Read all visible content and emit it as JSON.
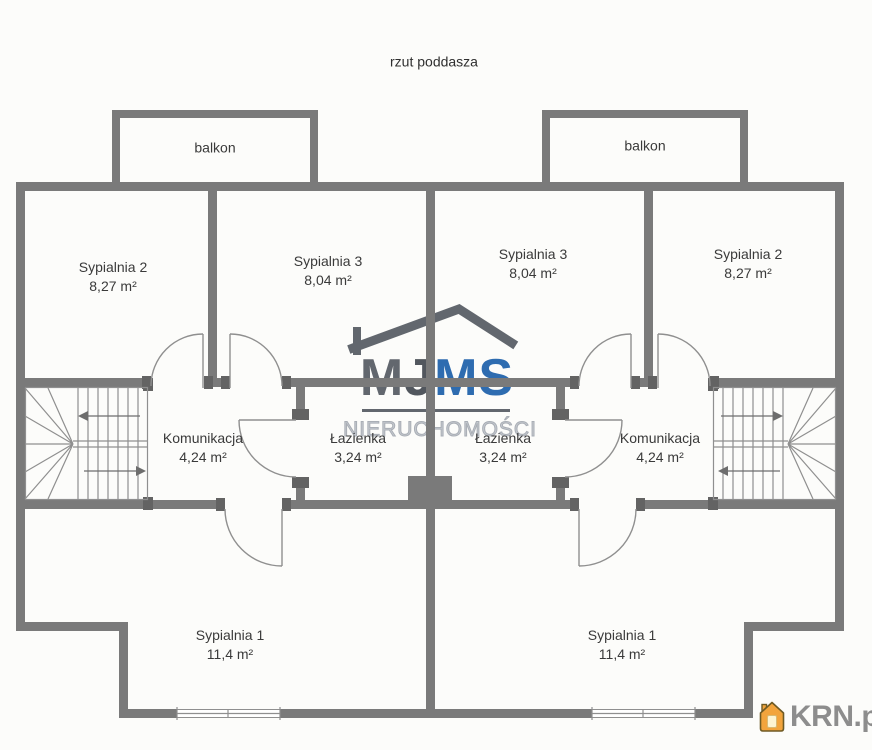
{
  "title": "rzut poddasza",
  "watermark": {
    "brand_m1": "M",
    "brand_j": "J",
    "brand_ms": "MS",
    "subtitle": "NIERUCHOMOŚCI"
  },
  "logo": {
    "text": "KRN.pl"
  },
  "colors": {
    "wall": "#7a7a7a",
    "jamb": "#636363",
    "thin_line": "#8f8f8f",
    "label_text": "#3a3a3a",
    "watermark_gray": "#62676e",
    "watermark_dark": "#52575e",
    "watermark_blue": "#2e6cb0",
    "watermark_outline": "#a9aeb5",
    "logo_text": "#8d8d8d",
    "logo_house_fill": "#f2a43c",
    "logo_house_stroke": "#6e5a24"
  },
  "units": {
    "left": {
      "balcony": "balkon",
      "bedroom2": {
        "name": "Sypialnia 2",
        "area": "8,27 m²"
      },
      "bedroom3": {
        "name": "Sypialnia 3",
        "area": "8,04 m²"
      },
      "hall": {
        "name": "Komunikacja",
        "area": "4,24 m²"
      },
      "bath": {
        "name": "Łazienka",
        "area": "3,24 m²"
      },
      "bedroom1": {
        "name": "Sypialnia 1",
        "area": "11,4 m²"
      }
    },
    "right": {
      "balcony": "balkon",
      "bedroom3": {
        "name": "Sypialnia 3",
        "area": "8,04 m²"
      },
      "bedroom2": {
        "name": "Sypialnia 2",
        "area": "8,27 m²"
      },
      "bath": {
        "name": "Łazienka",
        "area": "3,24 m²"
      },
      "hall": {
        "name": "Komunikacja",
        "area": "4,24 m²"
      },
      "bedroom1": {
        "name": "Sypialnia 1",
        "area": "11,4 m²"
      }
    }
  }
}
